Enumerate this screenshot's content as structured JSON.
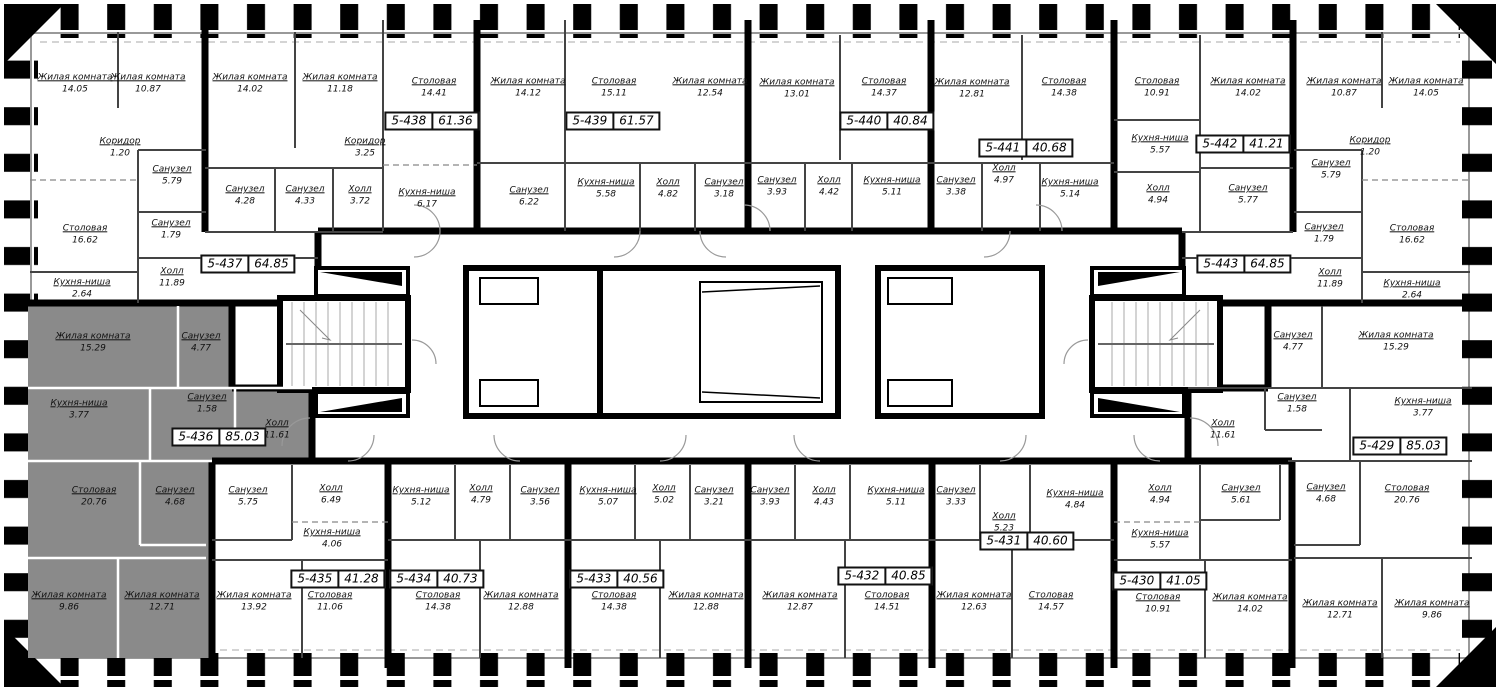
{
  "plan": {
    "selected_apartment": "5-436",
    "colors": {
      "wall": "#000000",
      "selected_fill": "#8a8a8a",
      "partition": "#555555",
      "facade": "#999999"
    },
    "apartments": [
      {
        "id": "5-437",
        "area": "64.85"
      },
      {
        "id": "5-438",
        "area": "61.36"
      },
      {
        "id": "5-439",
        "area": "61.57"
      },
      {
        "id": "5-440",
        "area": "40.84"
      },
      {
        "id": "5-441",
        "area": "40.68"
      },
      {
        "id": "5-442",
        "area": "41.21"
      },
      {
        "id": "5-443",
        "area": "64.85"
      },
      {
        "id": "5-436",
        "area": "85.03"
      },
      {
        "id": "5-429",
        "area": "85.03"
      },
      {
        "id": "5-435",
        "area": "41.28"
      },
      {
        "id": "5-434",
        "area": "40.73"
      },
      {
        "id": "5-433",
        "area": "40.56"
      },
      {
        "id": "5-432",
        "area": "40.85"
      },
      {
        "id": "5-431",
        "area": "40.60"
      },
      {
        "id": "5-430",
        "area": "41.05"
      }
    ],
    "rooms": [
      {
        "name": "Жилая комната",
        "area": "14.05"
      },
      {
        "name": "Жилая комната",
        "area": "10.87"
      },
      {
        "name": "Коридор",
        "area": "1.20"
      },
      {
        "name": "Санузел",
        "area": "5.79"
      },
      {
        "name": "Столовая",
        "area": "16.62"
      },
      {
        "name": "Санузел",
        "area": "1.79"
      },
      {
        "name": "Кухня-ниша",
        "area": "2.64"
      },
      {
        "name": "Холл",
        "area": "11.89"
      },
      {
        "name": "Жилая комната",
        "area": "14.02"
      },
      {
        "name": "Жилая комната",
        "area": "11.18"
      },
      {
        "name": "Коридор",
        "area": "3.25"
      },
      {
        "name": "Санузел",
        "area": "4.28"
      },
      {
        "name": "Санузел",
        "area": "4.33"
      },
      {
        "name": "Холл",
        "area": "3.72"
      },
      {
        "name": "Столовая",
        "area": "14.41"
      },
      {
        "name": "Кухня-ниша",
        "area": "6.17"
      },
      {
        "name": "Жилая комната",
        "area": "14.12"
      },
      {
        "name": "Санузел",
        "area": "6.22"
      },
      {
        "name": "Столовая",
        "area": "15.11"
      },
      {
        "name": "Кухня-ниша",
        "area": "5.58"
      },
      {
        "name": "Холл",
        "area": "4.82"
      },
      {
        "name": "Жилая комната",
        "area": "12.54"
      },
      {
        "name": "Санузел",
        "area": "3.18"
      },
      {
        "name": "Жилая комната",
        "area": "13.01"
      },
      {
        "name": "Санузел",
        "area": "3.93"
      },
      {
        "name": "Холл",
        "area": "4.42"
      },
      {
        "name": "Столовая",
        "area": "14.37"
      },
      {
        "name": "Кухня-ниша",
        "area": "5.11"
      },
      {
        "name": "Жилая комната",
        "area": "12.81"
      },
      {
        "name": "Санузел",
        "area": "3.38"
      },
      {
        "name": "Холл",
        "area": "4.97"
      },
      {
        "name": "Столовая",
        "area": "14.38"
      },
      {
        "name": "Кухня-ниша",
        "area": "5.14"
      },
      {
        "name": "Столовая",
        "area": "10.91"
      },
      {
        "name": "Кухня-ниша",
        "area": "5.57"
      },
      {
        "name": "Холл",
        "area": "4.94"
      },
      {
        "name": "Жилая комната",
        "area": "14.02"
      },
      {
        "name": "Санузел",
        "area": "5.77"
      },
      {
        "name": "Жилая комната",
        "area": "10.87"
      },
      {
        "name": "Жилая комната",
        "area": "14.05"
      },
      {
        "name": "Коридор",
        "area": "1.20"
      },
      {
        "name": "Санузел",
        "area": "5.79"
      },
      {
        "name": "Санузел",
        "area": "1.79"
      },
      {
        "name": "Столовая",
        "area": "16.62"
      },
      {
        "name": "Холл",
        "area": "11.89"
      },
      {
        "name": "Кухня-ниша",
        "area": "2.64"
      },
      {
        "name": "Жилая комната",
        "area": "15.29"
      },
      {
        "name": "Санузел",
        "area": "4.77"
      },
      {
        "name": "Санузел",
        "area": "1.58"
      },
      {
        "name": "Кухня-ниша",
        "area": "3.77"
      },
      {
        "name": "Холл",
        "area": "11.61"
      },
      {
        "name": "Столовая",
        "area": "20.76"
      },
      {
        "name": "Санузел",
        "area": "4.68"
      },
      {
        "name": "Жилая комната",
        "area": "9.86"
      },
      {
        "name": "Жилая комната",
        "area": "12.71"
      },
      {
        "name": "Санузел",
        "area": "4.77"
      },
      {
        "name": "Жилая комната",
        "area": "15.29"
      },
      {
        "name": "Санузел",
        "area": "1.58"
      },
      {
        "name": "Кухня-ниша",
        "area": "3.77"
      },
      {
        "name": "Холл",
        "area": "11.61"
      },
      {
        "name": "Санузел",
        "area": "4.68"
      },
      {
        "name": "Столовая",
        "area": "20.76"
      },
      {
        "name": "Жилая комната",
        "area": "12.71"
      },
      {
        "name": "Жилая комната",
        "area": "9.86"
      },
      {
        "name": "Санузел",
        "area": "5.75"
      },
      {
        "name": "Холл",
        "area": "6.49"
      },
      {
        "name": "Кухня-ниша",
        "area": "4.06"
      },
      {
        "name": "Жилая комната",
        "area": "13.92"
      },
      {
        "name": "Столовая",
        "area": "11.06"
      },
      {
        "name": "Кухня-ниша",
        "area": "5.12"
      },
      {
        "name": "Холл",
        "area": "4.79"
      },
      {
        "name": "Санузел",
        "area": "3.56"
      },
      {
        "name": "Столовая",
        "area": "14.38"
      },
      {
        "name": "Жилая комната",
        "area": "12.88"
      },
      {
        "name": "Кухня-ниша",
        "area": "5.07"
      },
      {
        "name": "Холл",
        "area": "5.02"
      },
      {
        "name": "Санузел",
        "area": "3.21"
      },
      {
        "name": "Столовая",
        "area": "14.38"
      },
      {
        "name": "Жилая комната",
        "area": "12.88"
      },
      {
        "name": "Санузел",
        "area": "3.93"
      },
      {
        "name": "Холл",
        "area": "4.43"
      },
      {
        "name": "Кухня-ниша",
        "area": "5.11"
      },
      {
        "name": "Жилая комната",
        "area": "12.87"
      },
      {
        "name": "Столовая",
        "area": "14.51"
      },
      {
        "name": "Санузел",
        "area": "3.33"
      },
      {
        "name": "Холл",
        "area": "5.23"
      },
      {
        "name": "Кухня-ниша",
        "area": "4.84"
      },
      {
        "name": "Жилая комната",
        "area": "12.63"
      },
      {
        "name": "Столовая",
        "area": "14.57"
      },
      {
        "name": "Холл",
        "area": "4.94"
      },
      {
        "name": "Санузел",
        "area": "5.61"
      },
      {
        "name": "Кухня-ниша",
        "area": "5.57"
      },
      {
        "name": "Столовая",
        "area": "10.91"
      },
      {
        "name": "Жилая комната",
        "area": "14.02"
      }
    ]
  }
}
